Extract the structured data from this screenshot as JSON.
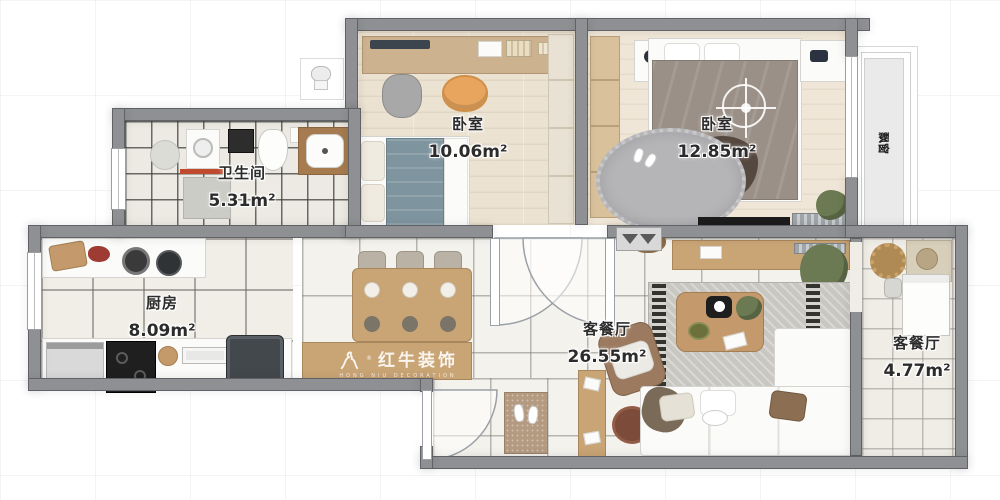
{
  "rooms": [
    {
      "id": "bedroom-1",
      "name": "卧室",
      "area": "10.06m²"
    },
    {
      "id": "bedroom-2",
      "name": "卧室",
      "area": "12.85m²"
    },
    {
      "id": "bathroom",
      "name": "卫生间",
      "area": "5.31m²"
    },
    {
      "id": "kitchen",
      "name": "厨房",
      "area": "8.09m²"
    },
    {
      "id": "living-dining",
      "name": "客餐厅",
      "area": "26.55m²"
    },
    {
      "id": "side-room",
      "name": "客餐厅",
      "area": "4.77m²"
    }
  ],
  "annotations": {
    "bay_window": "飘窗"
  },
  "watermark": {
    "brand": "红牛装饰",
    "tagline": "HONG NIU DECORATION",
    "registered": "®"
  },
  "colors": {
    "wall": "#8e9093",
    "wood_furniture": "#c9a475",
    "bed1_duvet": "#7e949e",
    "bed2_duvet": "#9a9087",
    "accent_orange": "#e7a55e",
    "red_mat": "#bf4a2e"
  }
}
